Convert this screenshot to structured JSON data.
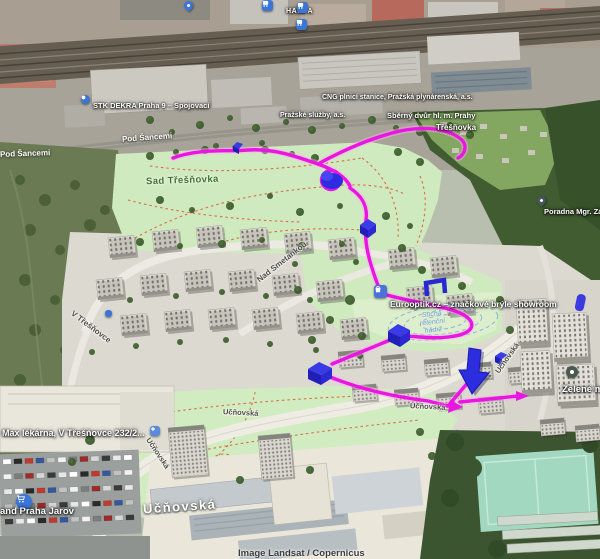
{
  "app": {
    "name": "3D satellite map view"
  },
  "attribution": "Image Landsat / Copernicus",
  "labels": {
    "harfa": "HARFA",
    "stk_dekra": "STK DEKRA Praha 9 – Spojovací",
    "cng": "CNG plnicí stanice, Pražská plynárenská, a.s.",
    "prazske_sluzby": "Pražské služby, a.s.",
    "sberny_dvur": "Sběrný dvůr hl. m. Prahy",
    "tresnovka": "Třešňovka",
    "pod_sancemi_a": "Pod Šancemi",
    "pod_sancemi_b": "Pod Šancemi",
    "sad_tresnovka": "Sad Třešňovka",
    "poradna": "Poradna Mgr. Zá",
    "nad_smetankou": "Nad Smetankou",
    "v_tresnovce": "V Třešňovce",
    "eurooptik": "Eurooptik.cz – značkové brýle showroom",
    "retencni_1": "Suchá",
    "retencni_2": "retenční",
    "retencni_3": "nádrž",
    "max_lekarna": "Max lékárna, V Třešňovce 232/2...",
    "kaufland": "and Praha  Jarov",
    "zelene_mesto": "Zelené mě",
    "ucnovska_big": "Učňovská",
    "ucnovska_road_a": "Učňovská",
    "ucnovska_road_b": "Učňovská",
    "ucnovska_road_c": "Učňovská",
    "ucnovska_road_d": "Učňovská"
  },
  "colors": {
    "route_magenta": "#e816e0",
    "overlay_blue": "#2d2de0",
    "park_green": "#cfeabf",
    "poi_blue": "#3b76d6",
    "trail_red": "#de5f3a"
  }
}
